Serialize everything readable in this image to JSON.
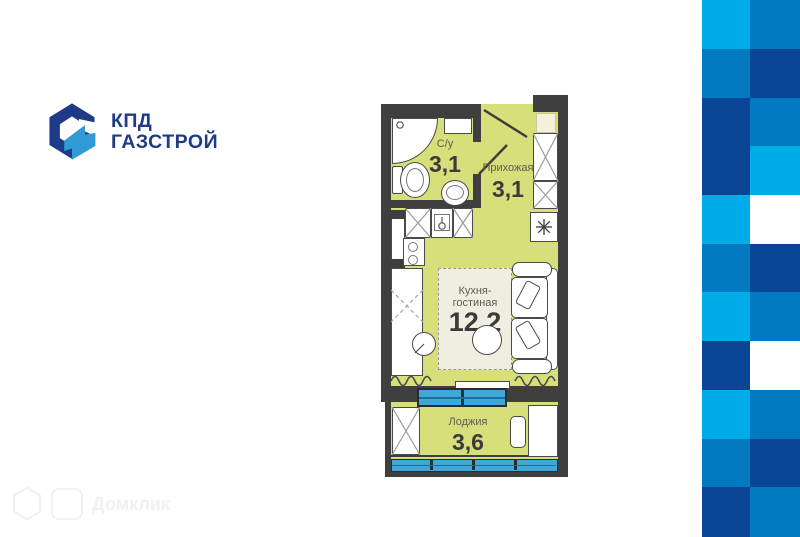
{
  "logo": {
    "line1": "КПД",
    "line2": "ГАЗСТРОЙ",
    "navy": "#1e3b87",
    "blue": "#2f9ad6"
  },
  "watermark": {
    "text": "Домклик"
  },
  "plan": {
    "rooms": [
      {
        "name": "С/у",
        "area": "3,1"
      },
      {
        "name": "Прихожая",
        "area": "3,1"
      },
      {
        "name": "Кухня-гостиная",
        "area": "12,2"
      },
      {
        "name": "Лоджия",
        "area": "3,6"
      }
    ],
    "colors": {
      "floor": "#d7df7b",
      "wall": "#3f3f3f",
      "rug": "#efeee1",
      "window_glass": "#3fa7da",
      "window_frame": "#2c2c2c",
      "pale_shaft": "#f3f1da"
    }
  },
  "pattern": {
    "palette": {
      "cyan": "#00ace8",
      "medium": "#0079c1",
      "navy": "#0a4494",
      "white": "#ffffff"
    },
    "columns": [
      {
        "x": 702,
        "w": 48
      },
      {
        "x": 750,
        "w": 50
      }
    ],
    "row_height": 48.727,
    "rows": [
      [
        "cyan",
        "medium"
      ],
      [
        "medium",
        "navy"
      ],
      [
        "navy",
        "medium"
      ],
      [
        "navy",
        "cyan"
      ],
      [
        "cyan",
        "white"
      ],
      [
        "medium",
        "navy"
      ],
      [
        "cyan",
        "medium"
      ],
      [
        "navy",
        "white"
      ],
      [
        "cyan",
        "medium"
      ],
      [
        "medium",
        "navy"
      ],
      [
        "navy",
        "medium"
      ]
    ]
  }
}
